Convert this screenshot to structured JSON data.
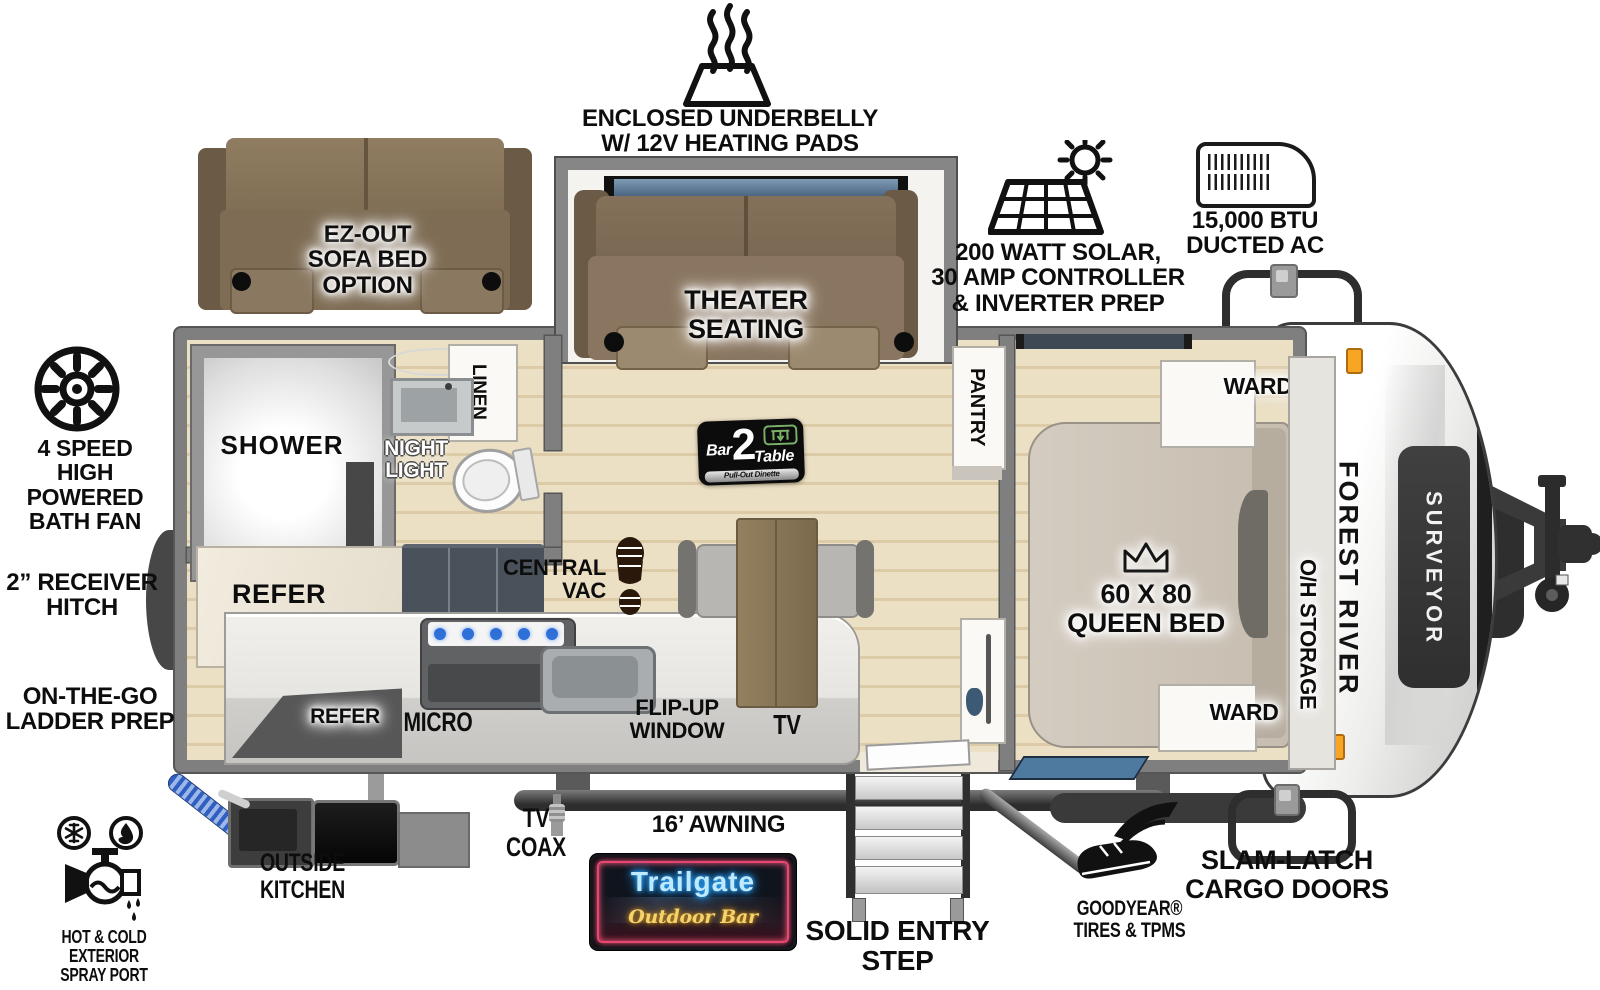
{
  "callouts": {
    "underbelly": "ENCLOSED UNDERBELLY\nW/ 12V HEATING PADS",
    "solar": "200 WATT SOLAR,\n30 AMP CONTROLLER\n& INVERTER PREP",
    "ac": "15,000 BTU\nDUCTED AC",
    "bath_fan": "4 SPEED\nHIGH POWERED\nBATH FAN",
    "receiver_hitch": "2” RECEIVER\nHITCH",
    "ladder_prep": "ON-THE-GO\nLADDER PREP",
    "spray_port": "HOT & COLD EXTERIOR\nSPRAY PORT",
    "outside_kitchen": "OUTSIDE KITCHEN",
    "tv_coax": "TV\nCOAX",
    "awning": "16’ AWNING",
    "entry_step": "SOLID ENTRY\nSTEP",
    "goodyear": "GOODYEAR®\nTIRES & TPMS",
    "slam_latch": "SLAM-LATCH\nCARGO DOORS"
  },
  "interior": {
    "shower": "SHOWER",
    "linen": "LINEN",
    "night_light": "NIGHT\nLIGHT",
    "refer": "REFER",
    "refer_outside": "REFER",
    "micro": "MICRO",
    "central_vac": "CENTRAL\nVAC",
    "flip_up_window": "FLIP-UP\nWINDOW",
    "tv": "TV",
    "pantry": "PANTRY",
    "ward_top": "WARD",
    "ward_bottom": "WARD",
    "oh_storage": "O/H STORAGE",
    "queen_bed": "60 X 80\nQUEEN BED",
    "theater_seating": "THEATER\nSEATING",
    "sofa_option": "EZ-OUT\nSOFA BED\nOPTION"
  },
  "badges": {
    "trailgate_line1": "Trailgate",
    "trailgate_line2": "Outdoor Bar",
    "bar2table": {
      "bar": "Bar",
      "num": "2",
      "table": "Table",
      "sub": "Pull-Out Dinette"
    }
  },
  "branding": {
    "make": "FOREST RIVER",
    "model": "SURVEYOR"
  },
  "icons": {
    "heating-pads-icon": "trapezoid with heat waves",
    "solar-panel-icon": "solar grid with sun",
    "ac-unit-icon": "rooftop AC shroud",
    "cargo-door-icon": "rounded door outline with latch",
    "bath-fan-icon": "spoked fan wheel",
    "spray-port-icon": "faucet with snowflake and flame",
    "coax-connector-icon": "coax fitting",
    "goodyear-wingfoot-icon": "winged boot",
    "footprint-icon": "boot print",
    "crown-icon": "queen crown",
    "entry-steps-icon": "stair steps"
  },
  "colors": {
    "wall_gray": "#7f7f7f",
    "wood_floor": "#e8dcc1",
    "sofa_brown": "#7e6c54",
    "bed_tan": "#ccc3b6",
    "neon_blue": "#9fdcff",
    "neon_gold": "#f5d36b",
    "neon_red": "#ff4d6e",
    "burner_blue": "#2f6fd8",
    "amber_marker": "#f6a623"
  }
}
